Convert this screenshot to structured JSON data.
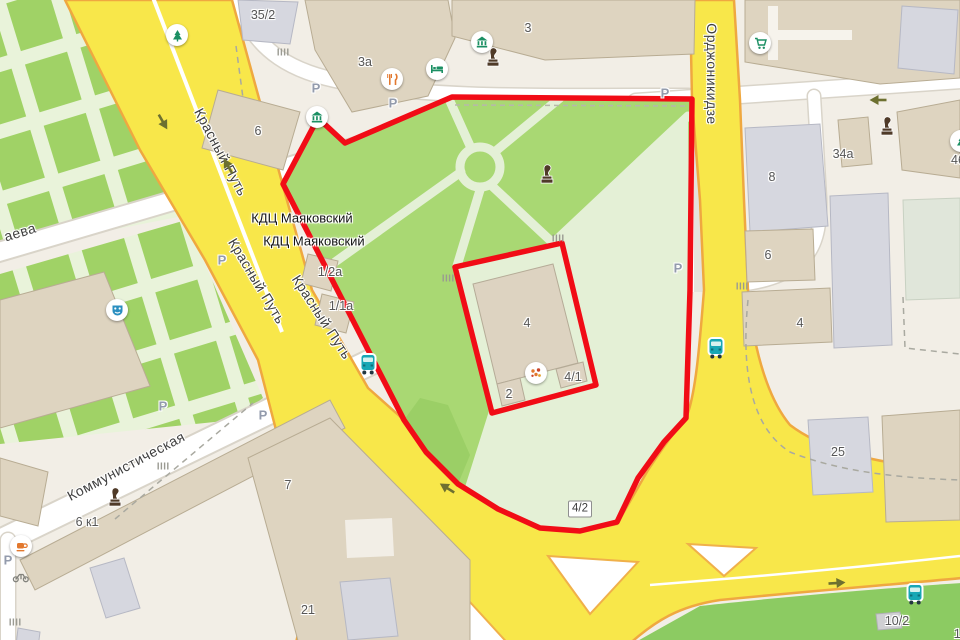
{
  "map": {
    "colors": {
      "selection_red": "#f10c16",
      "road_yellow": "#f8e74a",
      "road_casing_orange": "#efa840",
      "park_green": "#a9d873",
      "park_pale": "#e4f0d6",
      "hedge_green": "#a0d266",
      "building_beige": "#ded4c0",
      "building_gray": "#d6d7df",
      "bus_teal": "#18a7b5",
      "label_gray": "#565656"
    },
    "street_labels": [
      {
        "text": "Красный Путь",
        "x": 221,
        "y": 152,
        "rot": 62
      },
      {
        "text": "Красный Путь",
        "x": 257,
        "y": 281,
        "rot": 59
      },
      {
        "text": "Красный Путь",
        "x": 322,
        "y": 317,
        "rot": 57
      },
      {
        "text": "Орджоникидзе",
        "x": 712,
        "y": 74,
        "rot": 90
      },
      {
        "text": "Коммунистическая",
        "x": 126,
        "y": 466,
        "rot": -28
      },
      {
        "text": "аева",
        "x": 20,
        "y": 232,
        "rot": -17
      }
    ],
    "poi_labels": [
      {
        "text": "КДЦ Маяковский",
        "x": 302,
        "y": 218
      },
      {
        "text": "КДЦ Маяковский",
        "x": 314,
        "y": 241
      }
    ],
    "addresses": [
      {
        "text": "35/2",
        "x": 263,
        "y": 15
      },
      {
        "text": "3а",
        "x": 365,
        "y": 62
      },
      {
        "text": "3",
        "x": 528,
        "y": 28
      },
      {
        "text": "6",
        "x": 258,
        "y": 131
      },
      {
        "text": "8",
        "x": 772,
        "y": 177
      },
      {
        "text": "34а",
        "x": 843,
        "y": 154
      },
      {
        "text": "46",
        "x": 958,
        "y": 160
      },
      {
        "text": "6",
        "x": 768,
        "y": 255
      },
      {
        "text": "4",
        "x": 800,
        "y": 323
      },
      {
        "text": "4",
        "x": 527,
        "y": 323
      },
      {
        "text": "2",
        "x": 509,
        "y": 394
      },
      {
        "text": "4/1",
        "x": 573,
        "y": 377
      },
      {
        "text": "1/2а",
        "x": 330,
        "y": 272
      },
      {
        "text": "1/1а",
        "x": 341,
        "y": 306
      },
      {
        "text": "25",
        "x": 838,
        "y": 452
      },
      {
        "text": "7",
        "x": 288,
        "y": 485
      },
      {
        "text": "6 к1",
        "x": 87,
        "y": 522
      },
      {
        "text": "21",
        "x": 308,
        "y": 610
      },
      {
        "text": "10/2",
        "x": 897,
        "y": 621
      },
      {
        "text": "10/2",
        "x": 966,
        "y": 634
      }
    ],
    "boxed_labels": [
      {
        "text": "4/2",
        "x": 580,
        "y": 509
      }
    ],
    "parking": [
      [
        316,
        88
      ],
      [
        393,
        103
      ],
      [
        665,
        93
      ],
      [
        678,
        268
      ],
      [
        222,
        260
      ],
      [
        163,
        406
      ],
      [
        263,
        415
      ],
      [
        8,
        560
      ]
    ],
    "arrows": [
      {
        "x": 163,
        "y": 122,
        "rot": 60
      },
      {
        "x": 228,
        "y": 166,
        "rot": 240
      },
      {
        "x": 447,
        "y": 488,
        "rot": 212
      },
      {
        "x": 837,
        "y": 583,
        "rot": -4
      },
      {
        "x": 878,
        "y": 100,
        "rot": 180
      }
    ],
    "icons": [
      {
        "type": "museum",
        "x": 317,
        "y": 117
      },
      {
        "type": "museum",
        "x": 482,
        "y": 42
      },
      {
        "type": "monument",
        "x": 493,
        "y": 58
      },
      {
        "type": "hotel",
        "x": 437,
        "y": 69
      },
      {
        "type": "restaurant",
        "x": 392,
        "y": 79
      },
      {
        "type": "park",
        "x": 177,
        "y": 35
      },
      {
        "type": "cart",
        "x": 760,
        "y": 43
      },
      {
        "type": "monument",
        "x": 887,
        "y": 127
      },
      {
        "type": "park",
        "x": 961,
        "y": 141
      },
      {
        "type": "monument",
        "x": 547,
        "y": 175
      },
      {
        "type": "theater",
        "x": 117,
        "y": 310
      },
      {
        "type": "bus",
        "x": 368,
        "y": 364
      },
      {
        "type": "bus",
        "x": 716,
        "y": 348
      },
      {
        "type": "monument",
        "x": 115,
        "y": 498
      },
      {
        "type": "cafe",
        "x": 21,
        "y": 546
      },
      {
        "type": "scooter",
        "x": 21,
        "y": 577
      },
      {
        "type": "flowers",
        "x": 536,
        "y": 373
      },
      {
        "type": "bus",
        "x": 915,
        "y": 594
      }
    ],
    "entrances": [
      [
        283,
        52
      ],
      [
        558,
        238
      ],
      [
        448,
        278
      ],
      [
        15,
        622
      ],
      [
        742,
        286
      ],
      [
        163,
        466
      ]
    ]
  }
}
